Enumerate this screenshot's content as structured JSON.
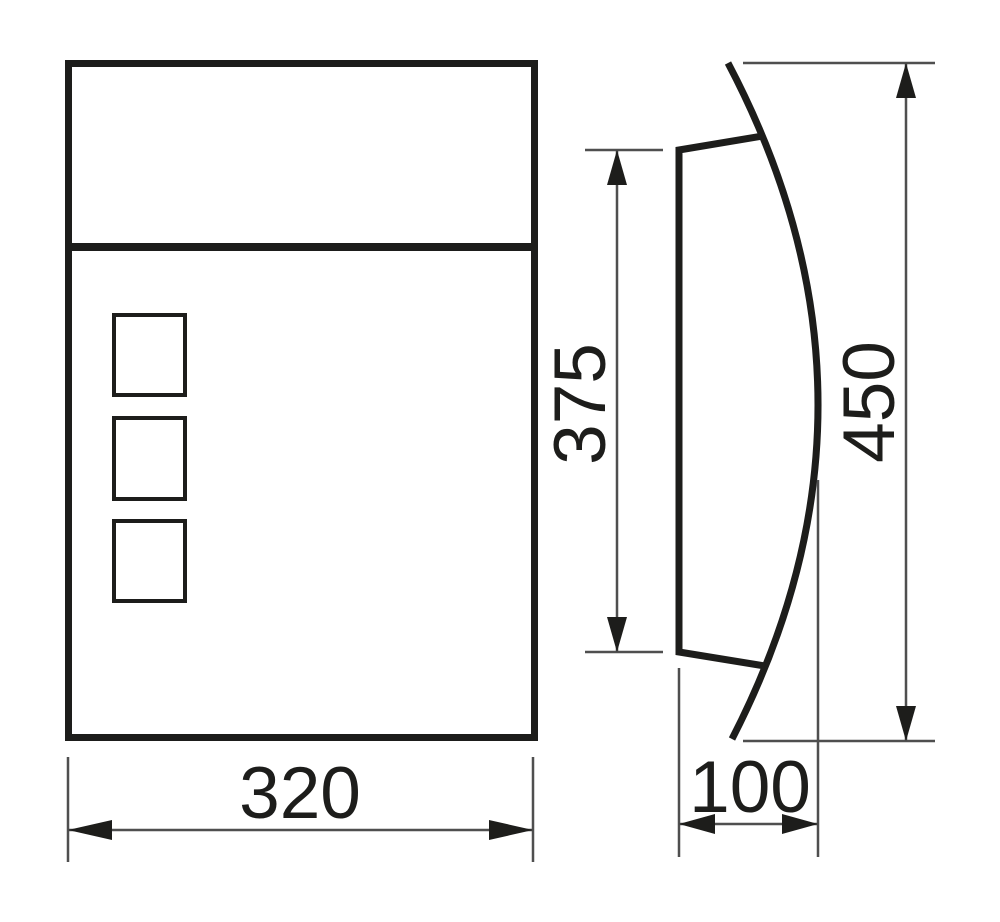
{
  "colors": {
    "line": "#1d1d1b",
    "thin": "#4f4f4f",
    "background": "#ffffff"
  },
  "dimensions": {
    "front_width": {
      "value": "320"
    },
    "door_height": {
      "value": "375"
    },
    "overall_height": {
      "value": "450"
    },
    "depth": {
      "value": "100"
    }
  }
}
